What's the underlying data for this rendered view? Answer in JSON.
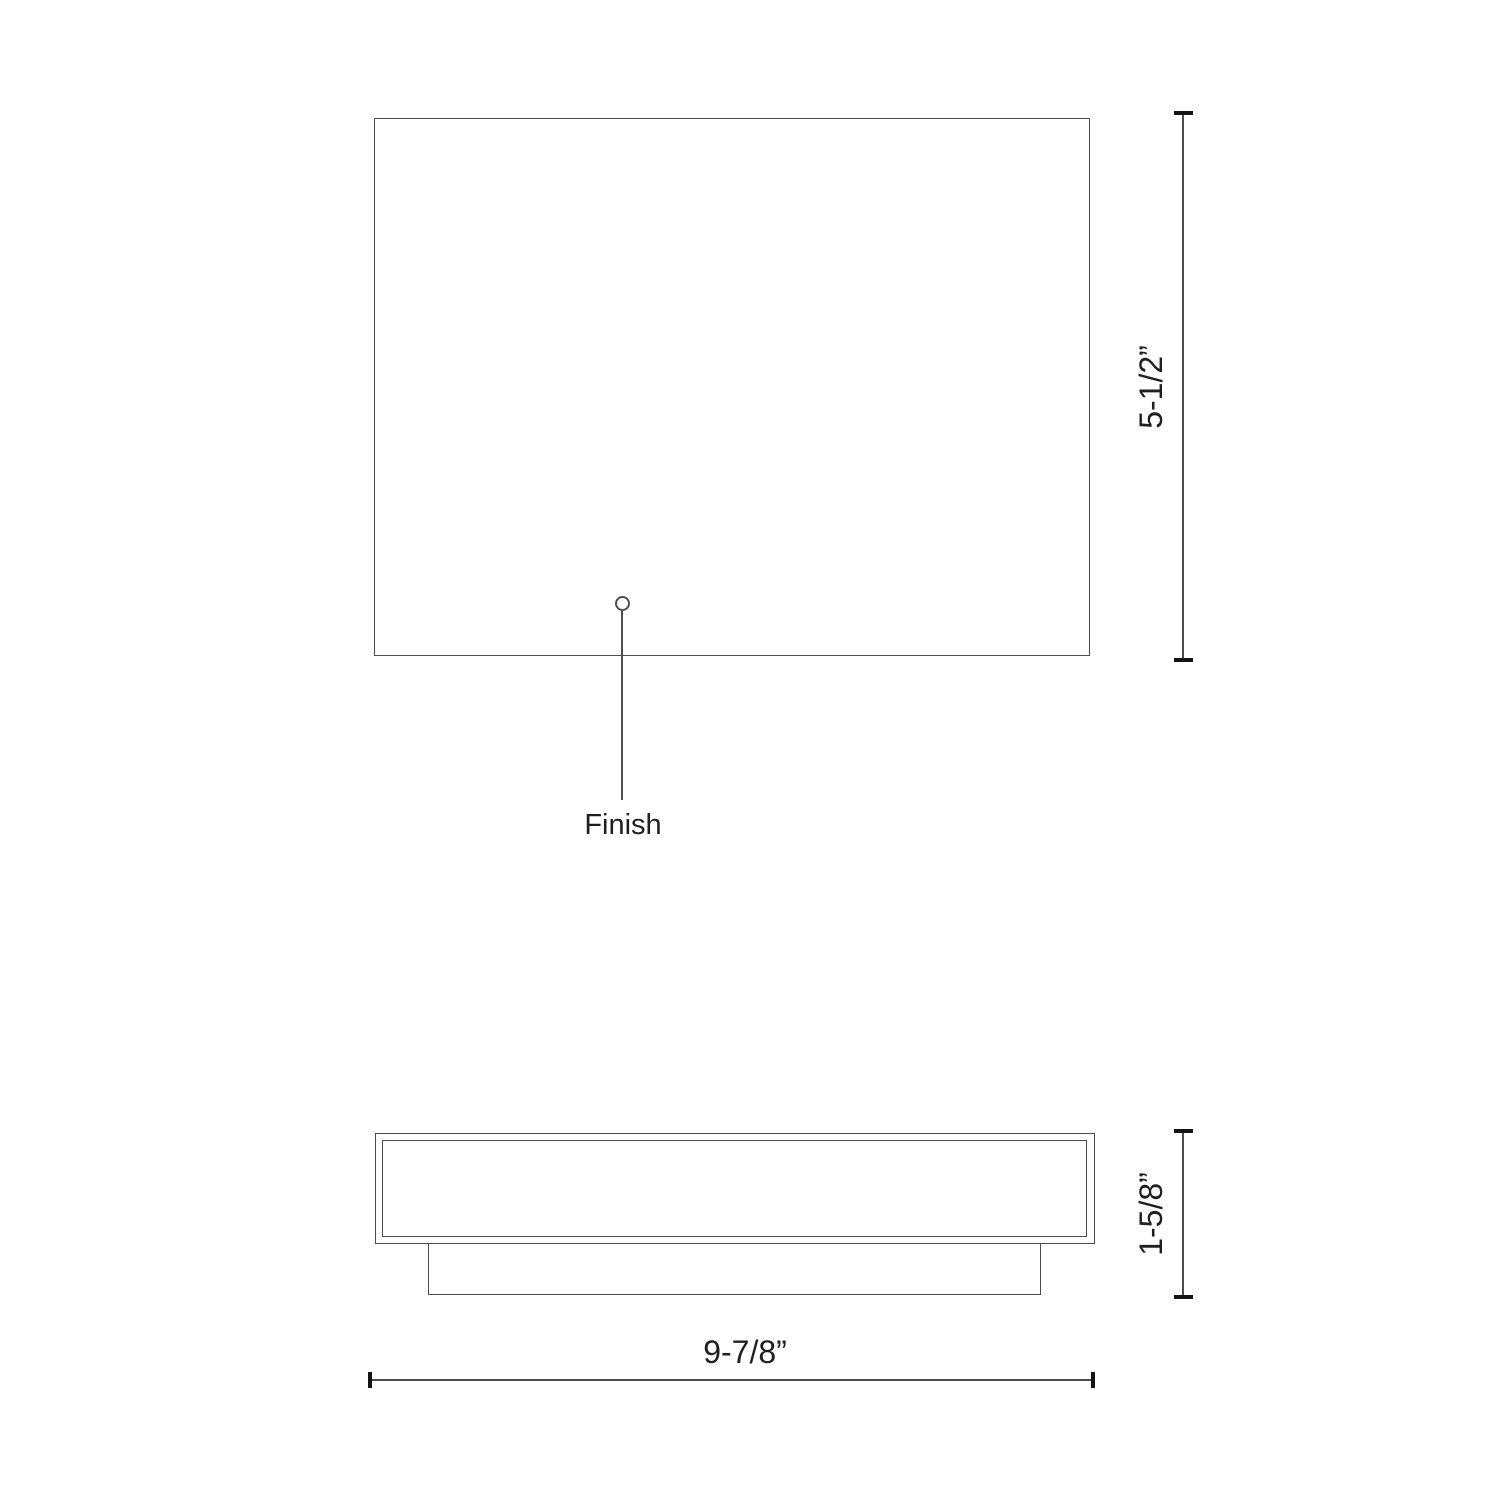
{
  "drawing": {
    "kind": "technical-dimension-diagram",
    "callout": {
      "finish_label": "Finish"
    },
    "dimensions": {
      "front_height": "5-1/2”",
      "side_height": "1-5/8”",
      "overall_width": "9-7/8”"
    },
    "colors": {
      "background": "#ffffff",
      "line": "#4d4d4d",
      "tick": "#141414",
      "text": "#1f1f1f"
    }
  }
}
